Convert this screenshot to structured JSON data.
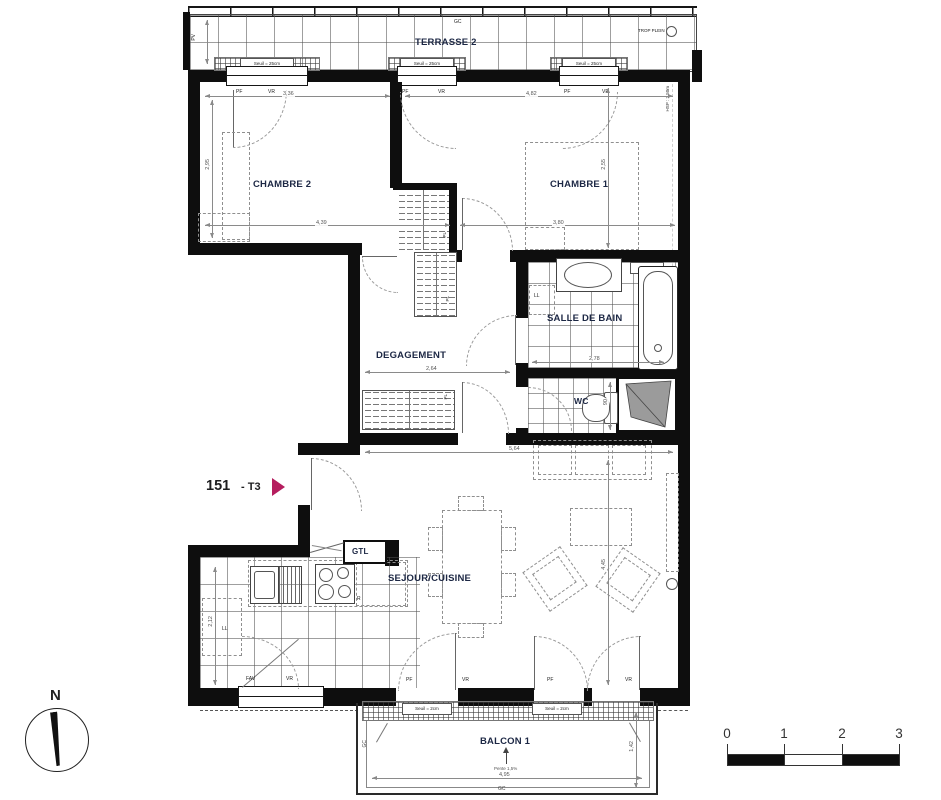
{
  "plan": {
    "unit_number": "151",
    "unit_type": "- T3",
    "accent_color": "#b51d5e"
  },
  "rooms": {
    "terrasse": "TERRASSE 2",
    "chambre2": "CHAMBRE 2",
    "chambre1": "CHAMBRE 1",
    "salle_de_bain": "SALLE DE BAIN",
    "degagement": "DEGAGEMENT",
    "wc": "WC",
    "sejour": "SEJOUR/CUISINE",
    "balcon": "BALCON 1",
    "gtl": "GTL"
  },
  "annotations": {
    "gc": "GC",
    "trop_plein": "TROP PLEIN",
    "pv": "PV",
    "hsp": "HSP : 2,50m",
    "ll": "LL",
    "r": "R",
    "pl": "PL",
    "pf": "PF",
    "vr": "VR",
    "fav": "FAV",
    "paillasse": "paillasse",
    "seuil_25": "Seuil = 25cm",
    "seuil_2": "Seuil = 2cm",
    "pente": "Pente 1,5%",
    "north": "N"
  },
  "dims": {
    "ch2_w": "3,36",
    "ch1_w": "4,82",
    "ch2_h": "2,95",
    "ch2_b": "4,39",
    "ch1_b": "3,80",
    "ch1_h": "2,55",
    "deg_w": "2,64",
    "sdb_w": "2,78",
    "sej_w": "5,64",
    "sej_h": "4,45",
    "kit_h": "2,12",
    "wc_w": "90",
    "balc_w": "4,95",
    "balc_h": "1,42"
  },
  "scalebar": {
    "labels": [
      "0",
      "1",
      "2",
      "3"
    ]
  }
}
